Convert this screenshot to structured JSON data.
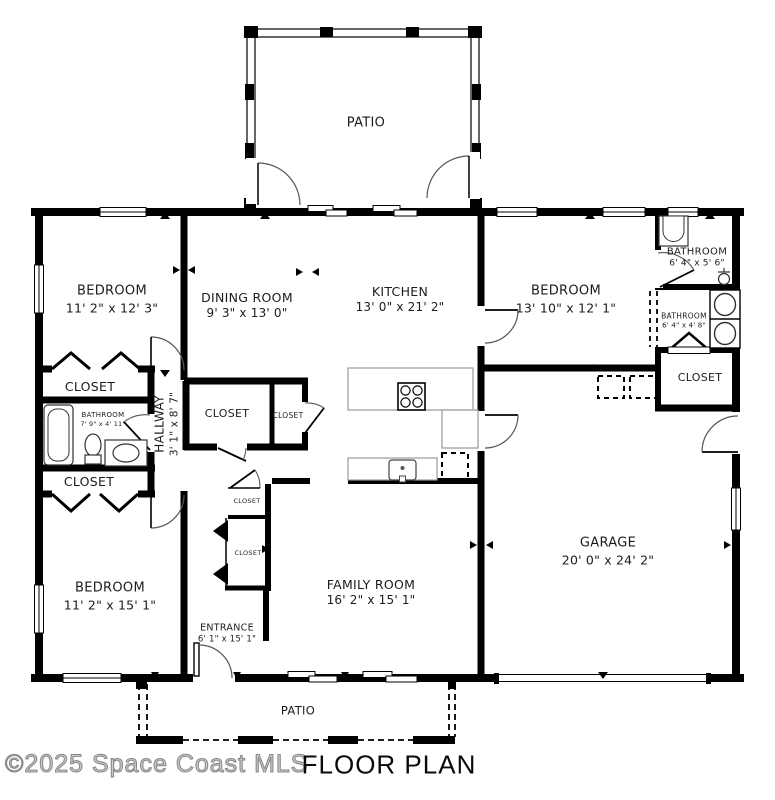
{
  "meta": {
    "title": "FLOOR PLAN",
    "watermark": "©2025 Space Coast MLS"
  },
  "colors": {
    "wall": "#000000",
    "background": "#ffffff",
    "counter_outline": "#999999",
    "watermark_outline": "#8a8a8a"
  },
  "labels": {
    "patio_top": {
      "name": "PATIO"
    },
    "bedroom_tl": {
      "name": "BEDROOM",
      "dims": "11' 2\" x 12' 3\""
    },
    "dining": {
      "name": "DINING ROOM",
      "dims": "9' 3\" x 13' 0\""
    },
    "kitchen": {
      "name": "KITCHEN",
      "dims": "13' 0\" x 21' 2\""
    },
    "bedroom_tr": {
      "name": "BEDROOM",
      "dims": "13' 10\" x 12' 1\""
    },
    "bath_tr": {
      "name": "BATHROOM",
      "dims": "6' 4\" x 5' 6\""
    },
    "bath_mr": {
      "name": "BATHROOM",
      "dims": "6' 4\" x 4' 8\""
    },
    "closet_r": {
      "name": "CLOSET"
    },
    "closet_l1": {
      "name": "CLOSET"
    },
    "bath_l": {
      "name": "BATHROOM",
      "dims": "7' 9\" x 4' 11\""
    },
    "hallway": {
      "name": "HALLWAY",
      "dims": "3' 1\" x 8' 7\""
    },
    "closet_l2": {
      "name": "CLOSET"
    },
    "closet_m1": {
      "name": "CLOSET"
    },
    "closet_m2": {
      "name": "CLOSET"
    },
    "closet_s1": {
      "name": "CLOSET"
    },
    "closet_s2": {
      "name": "CLOSET"
    },
    "bedroom_bl": {
      "name": "BEDROOM",
      "dims": "11' 2\" x 15' 1\""
    },
    "family": {
      "name": "FAMILY ROOM",
      "dims": "16' 2\" x 15' 1\""
    },
    "entrance": {
      "name": "ENTRANCE",
      "dims": "6' 1\" x 15' 1\""
    },
    "garage": {
      "name": "GARAGE",
      "dims": "20' 0\" x 24' 2\""
    },
    "patio_bottom": {
      "name": "PATIO"
    }
  }
}
